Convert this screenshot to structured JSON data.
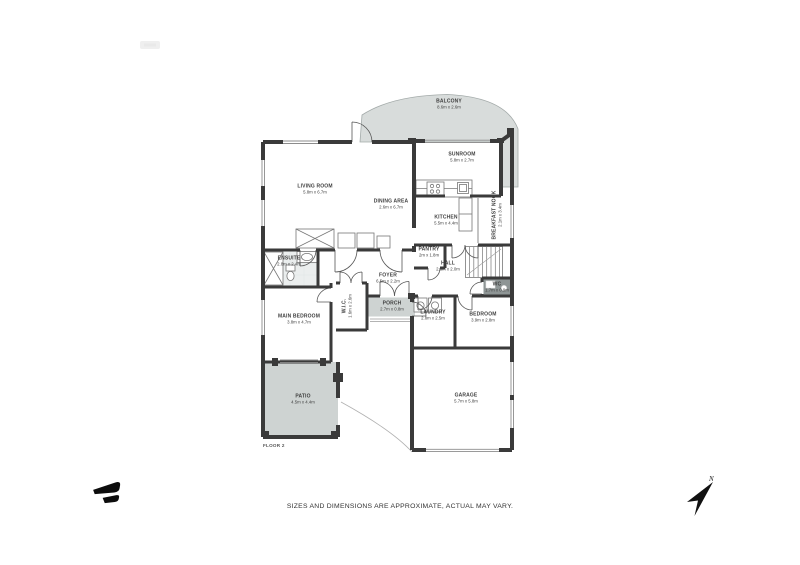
{
  "page": {
    "disclaimer": "SIZES AND DIMENSIONS ARE APPROXIMATE, ACTUAL MAY VARY.",
    "floor_label": "FLOOR 2",
    "compass_label": "N"
  },
  "colors": {
    "wall": "#3a3a3a",
    "balcony_fill": "#d8dcdb",
    "patio_fill": "#ced3d2",
    "porch_fill": "#ced3d2",
    "ensuite_fill": "#ebeeee",
    "wc_fill": "#8e9595",
    "door_arc": "#565656",
    "window_line": "#8c8c8c",
    "fixture_line": "#777777",
    "label_text": "#3f3f3f"
  },
  "rooms": [
    {
      "name": "BALCONY",
      "dims": "8.6m x 2.6m"
    },
    {
      "name": "SUNROOM",
      "dims": "5.8m x 2.7m"
    },
    {
      "name": "LIVING ROOM",
      "dims": "5.8m x 6.7m"
    },
    {
      "name": "DINING AREA",
      "dims": "2.6m x 6.7m"
    },
    {
      "name": "KITCHEN",
      "dims": "5.5m x 4.4m"
    },
    {
      "name": "BREAKFAST NOOK",
      "dims": "2.1m x 3.4m"
    },
    {
      "name": "PANTRY",
      "dims": "2m x 1.8m"
    },
    {
      "name": "HALL",
      "dims": "2.8m x 2.0m"
    },
    {
      "name": "ENSUITE",
      "dims": "2.8m x 2.4m"
    },
    {
      "name": "FOYER",
      "dims": "6.5m x 2.2m"
    },
    {
      "name": "W.I.C.",
      "dims": "1.6m x 2.6m"
    },
    {
      "name": "PORCH",
      "dims": "2.7m x 0.8m"
    },
    {
      "name": "MAIN BEDROOM",
      "dims": "3.8m x 4.7m"
    },
    {
      "name": "LAUNDRY",
      "dims": "2.8m x 2.5m"
    },
    {
      "name": "BEDROOM",
      "dims": "3.9m x 2.8m"
    },
    {
      "name": "WC",
      "dims": "1.7m x 0.9m"
    },
    {
      "name": "PATIO",
      "dims": "4.5m x 4.4m"
    },
    {
      "name": "GARAGE",
      "dims": "5.7m x 5.8m"
    }
  ]
}
